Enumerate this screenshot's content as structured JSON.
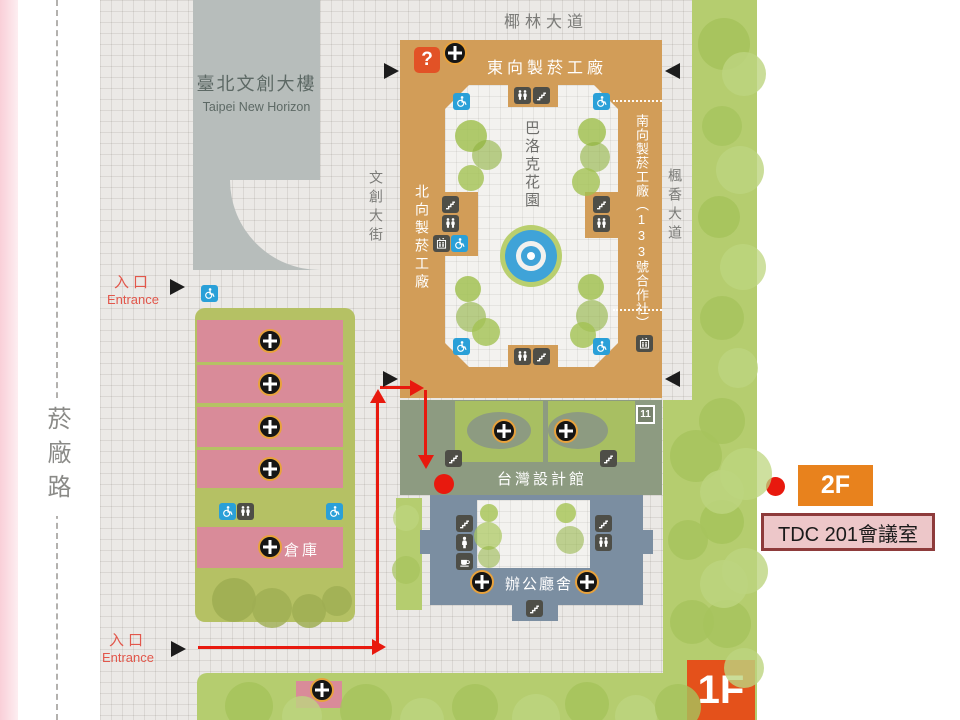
{
  "roads": {
    "top": "椰林大道",
    "left": "菸廠路",
    "center_street": "文創大街",
    "east_street": "楓香大道"
  },
  "buildings": {
    "new_horizon": {
      "title": "臺北文創大樓",
      "subtitle": "Taipei New Horizon"
    },
    "factory_east": "東向製菸工廠",
    "factory_north": "北向製菸工廠",
    "factory_south": "南向製菸工廠（133號合作社）",
    "baroque_garden": "巴洛克花園",
    "design_museum": "台灣設計館",
    "office_hall": "辦公廳舍",
    "warehouse": "倉庫"
  },
  "markers": {
    "question": "?",
    "site_number": "11"
  },
  "entrance": {
    "zh": "入口",
    "en": "Entrance"
  },
  "route": {
    "destination_floor": "2F",
    "destination_room": "TDC 201會議室",
    "current_floor": "1F"
  },
  "colors": {
    "factory_tan": "#d29d58",
    "park_green": "#b5cd6f",
    "pink_building": "#d98b99",
    "office_blue": "#7b8ea1",
    "museum_sage": "#8d9b81",
    "route_red": "#e8190e",
    "badge_orange": "#e8821d",
    "floor_orange": "#e4511b"
  }
}
